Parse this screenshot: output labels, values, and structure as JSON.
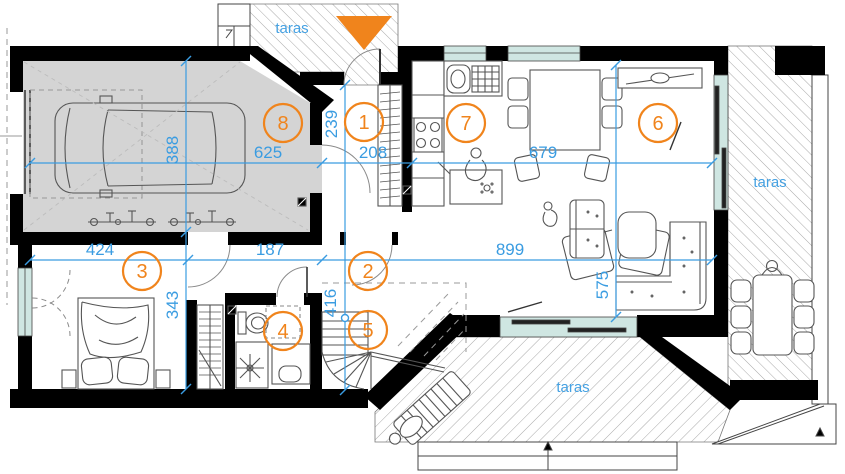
{
  "rooms": [
    {
      "number": "1"
    },
    {
      "number": "2"
    },
    {
      "number": "3"
    },
    {
      "number": "4"
    },
    {
      "number": "5"
    },
    {
      "number": "6"
    },
    {
      "number": "7"
    },
    {
      "number": "8"
    }
  ],
  "dims": {
    "garage_width": "625",
    "garage_depth": "388",
    "entry_depth": "239",
    "entry_width": "208",
    "kitchen_dining_width": "679",
    "bedroom_width": "424",
    "corridor_width": "187",
    "living_width": "899",
    "bedroom_depth": "343",
    "stairs_depth": "416",
    "living_depth": "575"
  },
  "terraces": {
    "top": "taras",
    "right": "taras",
    "bottom": "taras"
  },
  "colors": {
    "wall": "#000000",
    "dimension_blue": "#3a9ce1",
    "accent_orange": "#f0841c",
    "window_glass": "#cfe6e2",
    "garage_floor": "#d4d4d4"
  }
}
